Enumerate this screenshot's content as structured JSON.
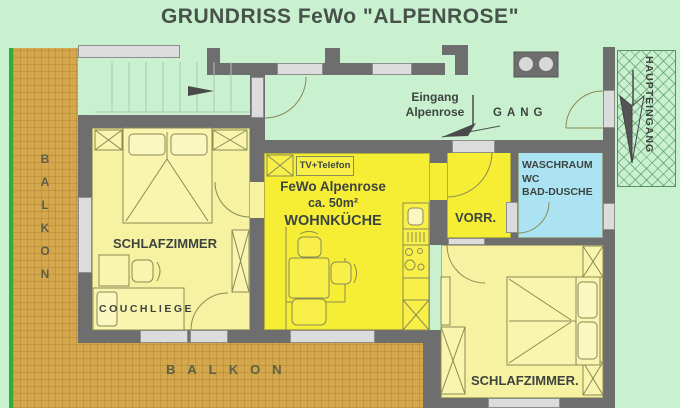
{
  "title": "GRUNDRISS FeWo \"ALPENROSE\"",
  "rooms": {
    "bedroom_left": {
      "label": "SCHLAFZIMMER"
    },
    "couch": {
      "label": "COUCHLIEGE"
    },
    "living_kitchen": {
      "tv_label": "TV+Telefon",
      "name": "FeWo Alpenrose",
      "area": "ca. 50m²",
      "label": "WOHNKÜCHE"
    },
    "vorraum": {
      "label": "VORR."
    },
    "washroom": {
      "line1": "WASCHRAUM",
      "line2": "WC",
      "line3": "BAD-DUSCHE"
    },
    "bedroom_right": {
      "label": "SCHLAFZIMMER."
    }
  },
  "corridor": {
    "gang": "GANG",
    "entrance_line1": "Eingang",
    "entrance_line2": "Alpenrose",
    "main_entrance": "HAUPTEINGANG"
  },
  "balcony": {
    "left": "BALKON",
    "bottom": "BALKON"
  },
  "colors": {
    "background": "#c9f1d0",
    "wall": "#6e6e6e",
    "window": "#dcdcdc",
    "room_pale_yellow": "#f7f2a2",
    "room_bright_yellow": "#f6ee35",
    "room_blue": "#abe3f3",
    "balcony_tan": "#d5a74d",
    "balcony_green_line": "#2fae3c",
    "text": "#3d443f"
  }
}
